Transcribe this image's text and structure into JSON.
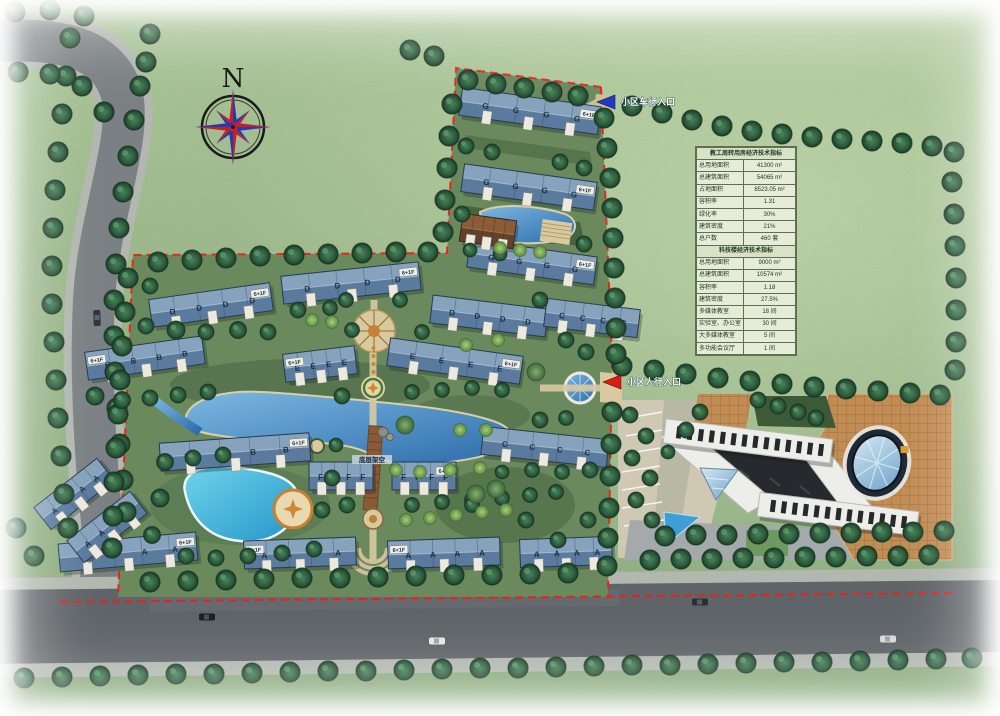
{
  "compass": {
    "north": "N"
  },
  "entrances": {
    "vehicle": "小区车行入口",
    "pedestrian": "小区人行入口"
  },
  "labels": {
    "floors": "6+1F",
    "stilt": "底层架空",
    "letters": {
      "a": "A",
      "b": "B",
      "c": "C",
      "d": "D",
      "e": "E",
      "f": "F",
      "g": "G"
    }
  },
  "table": {
    "s1_title": "教工周转用房经济技术指标",
    "s1": [
      {
        "k": "总用地面积",
        "v": "41300 m²"
      },
      {
        "k": "总建筑面积",
        "v": "54065 m²"
      },
      {
        "k": "占地面积",
        "v": "8523.05 m²"
      },
      {
        "k": "容积率",
        "v": "1.31"
      },
      {
        "k": "绿化率",
        "v": "30%"
      },
      {
        "k": "建筑密度",
        "v": "21%"
      },
      {
        "k": "总户数",
        "v": "460 套"
      }
    ],
    "s2_title": "科技楼经济技术指标",
    "s2": [
      {
        "k": "总用地面积",
        "v": "9000 m²"
      },
      {
        "k": "总建筑面积",
        "v": "10574 m²"
      },
      {
        "k": "容积率",
        "v": "1.18"
      },
      {
        "k": "建筑密度",
        "v": "27.5%"
      },
      {
        "k": "多媒体教室",
        "v": "18 间"
      },
      {
        "k": "实验室、办公室",
        "v": "30 间"
      },
      {
        "k": "大多媒体教室",
        "v": "5 间"
      },
      {
        "k": "多功能会议厅",
        "v": "1 间"
      }
    ]
  },
  "colors": {
    "boundary": "#ee1f18",
    "water": "#3f86c9",
    "roof": "#5d7da0",
    "plaza": "#c28d55"
  }
}
